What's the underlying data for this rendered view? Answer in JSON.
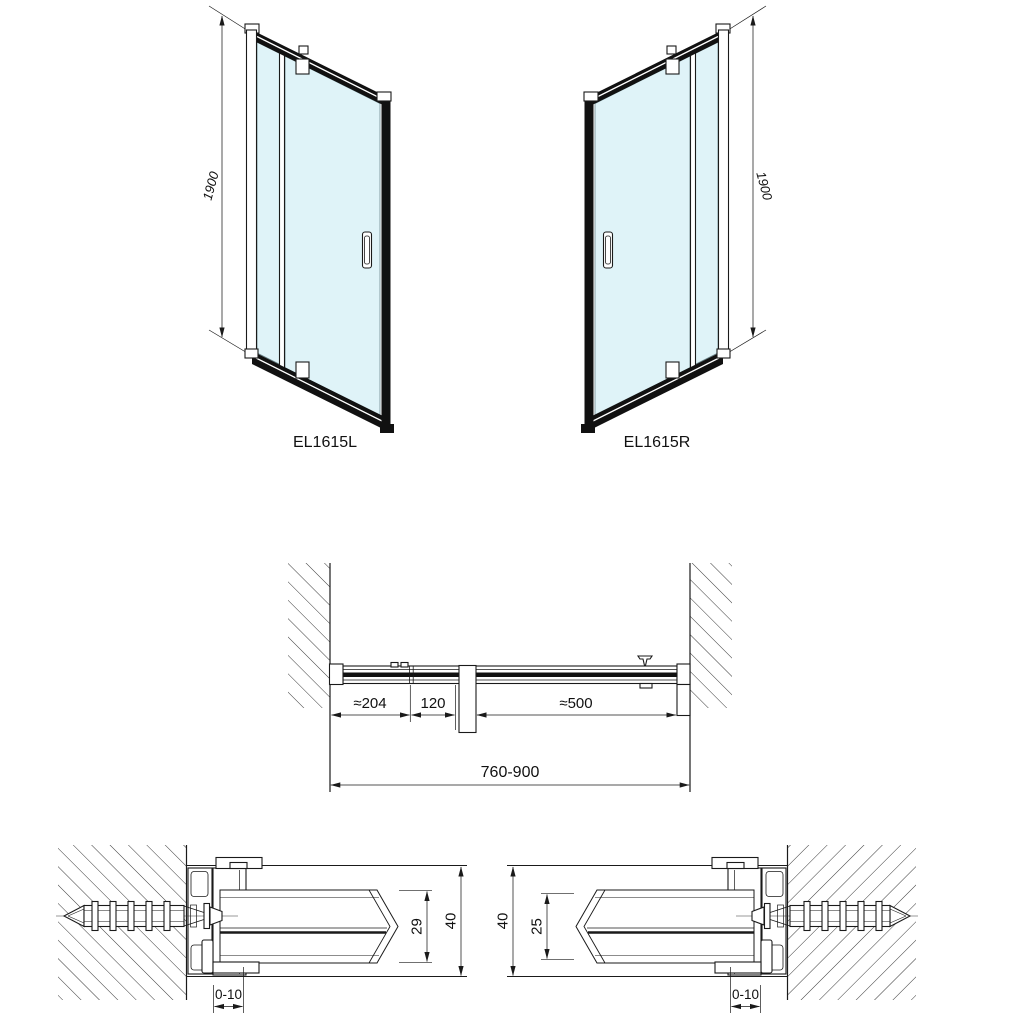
{
  "drawing": {
    "front_view_left": {
      "model_label": "EL1615L",
      "height_dim": "1900"
    },
    "front_view_right": {
      "model_label": "EL1615R",
      "height_dim": "1900"
    },
    "plan_view": {
      "dim_fixed_segment": "≈204",
      "dim_overlap_segment": "120",
      "dim_door_segment": "≈500",
      "dim_overall_width": "760-900"
    },
    "detail_left": {
      "dim_inner_depth": "29",
      "dim_outer_depth": "40",
      "dim_adjustment": "0-10"
    },
    "detail_right": {
      "dim_inner_depth": "25",
      "dim_outer_depth": "40",
      "dim_adjustment": "0-10"
    },
    "colors": {
      "glass": "#dff3f8",
      "line": "#1a1a1a"
    }
  }
}
